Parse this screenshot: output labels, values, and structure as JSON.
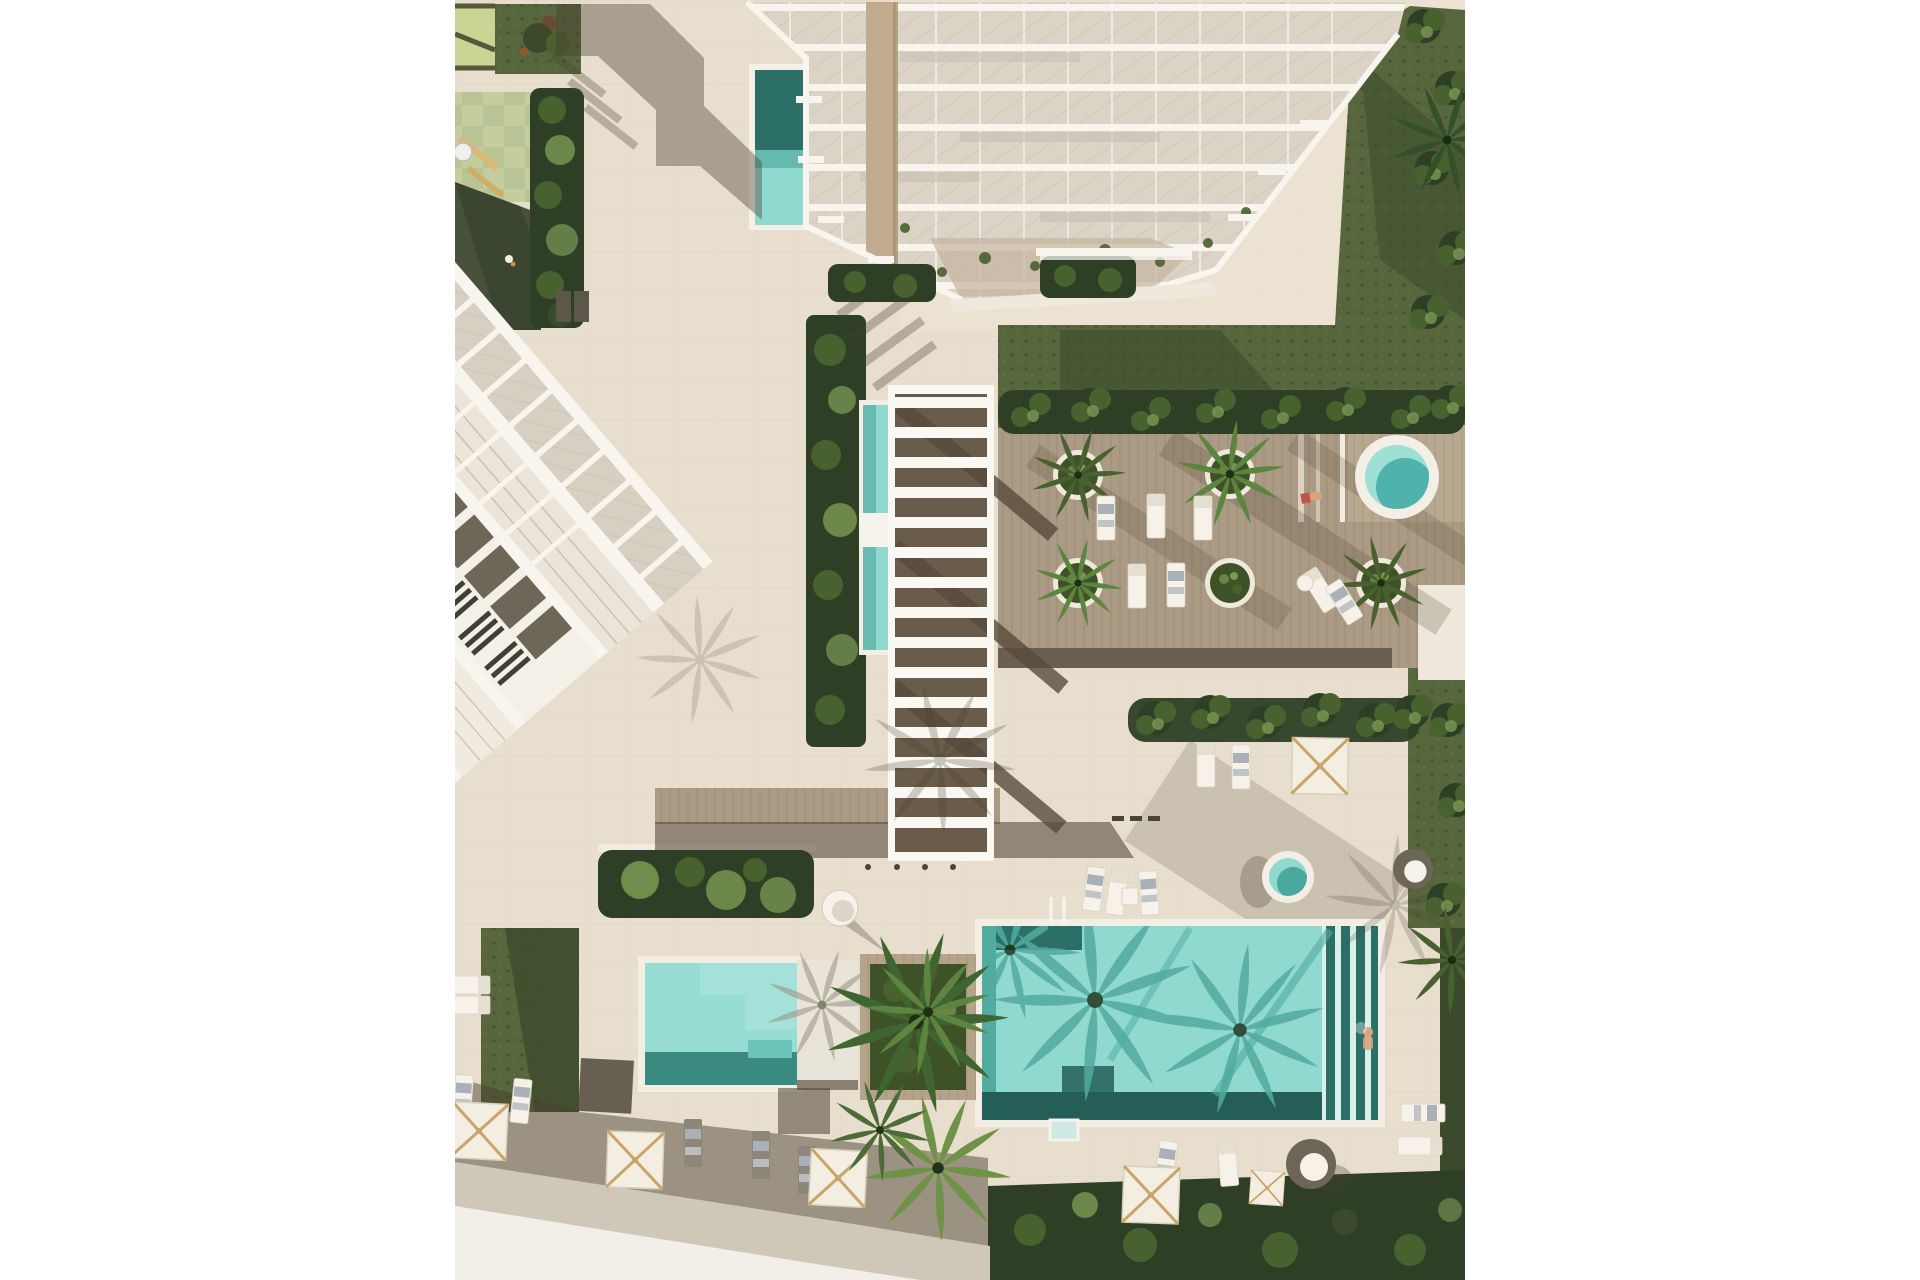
{
  "meta": {
    "title": "Aerial architectural rendering of a resort courtyard",
    "view": "top-down 3d render",
    "lighting": "bright daylight, long shadows toward lower-left"
  },
  "colors": {
    "margin": "#ffffff",
    "plaza": "#e8decd",
    "plazaLight": "#eee5d5",
    "road": "#cfc7b8",
    "roadLight": "#f2efe8",
    "shadow": "#4a3f31",
    "wood": "#ac9b84",
    "woodLight": "#b8a88f",
    "deckEdge": "#6a5f50",
    "pergWhite": "#faf8f3",
    "pergGap": "#7b6c59",
    "poolLight": "#8fd9cf",
    "poolMid": "#52ab9f",
    "poolDark": "#2c6f66",
    "poolDeep": "#245e56",
    "poolPale": "#d9efe9",
    "lawn": "#57663c",
    "lawnDark": "#3c4a2c",
    "hedge": "#2e3f26",
    "leaf": "#49602f",
    "leafLight": "#7d9a55",
    "rubber": "#475139",
    "checkA": "#c5cd9e",
    "checkB": "#b9c496",
    "lime": "#ccd494",
    "towerSlab": "#f8f5ef",
    "towerGlass": "#dbd4c6",
    "towerHatch": "#b3ab99",
    "towerCore": "#c0ab8e",
    "panelDark": "#6e6657",
    "windowDark": "#403e35",
    "buildingWhite": "#f3f0e8",
    "umbCanvas": "#f3eee1",
    "umbRib": "#c8a66a",
    "furniture": "#f6f2ea",
    "furnitureGray": "#8d8779",
    "towel": "#aab0b8",
    "planterRim": "#efe9dc",
    "planterFill": "#3f5227",
    "skin": "#d9a37e",
    "bench": "#5c564b"
  },
  "scene": {
    "buildings": [
      {
        "name": "tower-building",
        "desc": "white high-rise with stepped glass balcony slabs, seen from above, top center"
      },
      {
        "name": "townhouse-building",
        "desc": "diagonal row of white townhouses with dark terrace panels and skylight roofs, left side"
      }
    ],
    "pools": [
      {
        "name": "main-pool",
        "shape": "large rectangle",
        "location": "bottom right courtyard",
        "details": "palm shadows, swimmer, slatted infinity edge"
      },
      {
        "name": "small-pool",
        "shape": "rectangle",
        "location": "bottom left courtyard",
        "details": "white platform on right side"
      },
      {
        "name": "lap-pool",
        "shape": "narrow strip",
        "location": "center, along slatted pergola"
      },
      {
        "name": "tower-pool",
        "shape": "small rectangle",
        "location": "base of tower, half in shadow"
      },
      {
        "name": "spa-pool-deck",
        "shape": "round",
        "location": "upper-right timber deck"
      },
      {
        "name": "spa-pool-plaza",
        "shape": "round",
        "location": "mid-right plaza"
      }
    ],
    "features": [
      "white slatted pergola walkway",
      "timber sun deck with round palm planters",
      "white sun loungers with towels",
      "square canvas umbrellas with tan ribs",
      "wicker egg chairs",
      "children playground with rubber surface and pale green pavers",
      "tropical hedge strips and lawns",
      "palm trees casting long shadows",
      "swimmer in main pool",
      "sunbather on deck"
    ],
    "counts": {
      "round_planters": 5,
      "umbrellas": 6,
      "sun_loungers": 20,
      "egg_chairs": 2,
      "round_spas": 2
    }
  }
}
